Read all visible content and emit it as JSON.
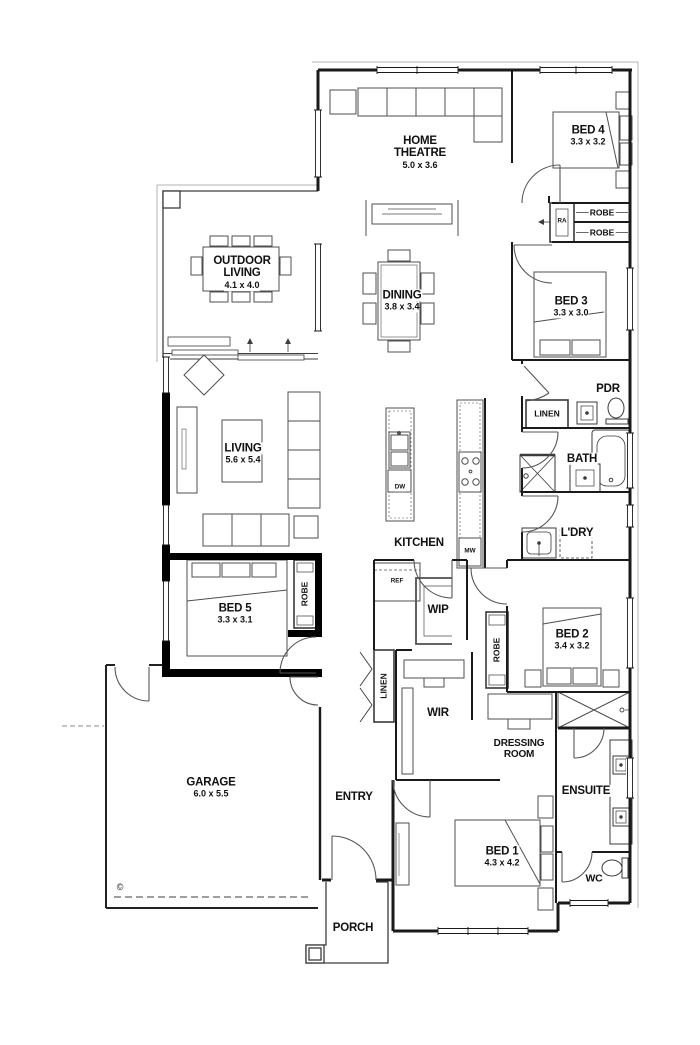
{
  "rooms": {
    "home_theatre": {
      "name": "HOME THEATRE",
      "dims": "5.0 x 3.6"
    },
    "outdoor_living": {
      "name": "OUTDOOR LIVING",
      "dims": "4.1 x 4.0"
    },
    "dining": {
      "name": "DINING",
      "dims": "3.8 x 3.4"
    },
    "living": {
      "name": "LIVING",
      "dims": "5.6 x 5.4"
    },
    "kitchen": {
      "name": "KITCHEN"
    },
    "bed1": {
      "name": "BED 1",
      "dims": "4.3 x 4.2"
    },
    "bed2": {
      "name": "BED 2",
      "dims": "3.4 x 3.2"
    },
    "bed3": {
      "name": "BED 3",
      "dims": "3.3 x 3.0"
    },
    "bed4": {
      "name": "BED 4",
      "dims": "3.3 x 3.2"
    },
    "bed5": {
      "name": "BED 5",
      "dims": "3.3 x 3.1"
    },
    "garage": {
      "name": "GARAGE",
      "dims": "6.0 x 5.5"
    },
    "entry": {
      "name": "ENTRY"
    },
    "porch": {
      "name": "PORCH"
    },
    "wip": {
      "name": "WIP"
    },
    "wir": {
      "name": "WIR"
    },
    "pdr": {
      "name": "PDR"
    },
    "bath": {
      "name": "BATH"
    },
    "ldry": {
      "name": "L'DRY"
    },
    "ensuite": {
      "name": "ENSUITE"
    },
    "wc": {
      "name": "WC"
    },
    "dressing": {
      "name": "DRESSING ROOM"
    }
  },
  "storage": {
    "robe_bed4_top": "ROBE",
    "robe_bed4_bottom": "ROBE",
    "robe_bed5": "ROBE",
    "robe_bed2": "ROBE",
    "linen_hall": "LINEN",
    "linen_entry": "LINEN"
  },
  "appliances": {
    "ra": "RA",
    "ref": "REF",
    "dw": "DW",
    "mw": "MW"
  },
  "annotations": {
    "copyright": "©"
  },
  "colors": {
    "wall": "#1a1a1a",
    "furniture": "#4f4f4f",
    "background": "#ffffff"
  }
}
